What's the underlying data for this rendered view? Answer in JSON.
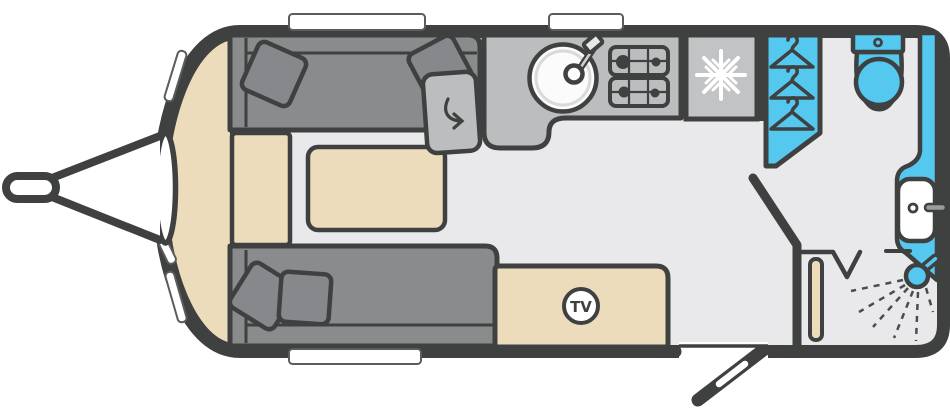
{
  "floorplan": {
    "type": "caravan-floorplan",
    "tv_badge": {
      "label": "TV"
    },
    "colors": {
      "outline": "#3F4040",
      "floor": "#E9E9EB",
      "upholstery": "#8A8B8D",
      "cushion": "#87888C",
      "worktop": "#BCBDBF",
      "fridge": "#C2C3C5",
      "wood": "#EDDCBB",
      "wet_area_blue": "#55C8F0",
      "white": "#FFFFFF",
      "spray": "#4A4C4E"
    },
    "features": [
      {
        "id": "tow-hitch",
        "label": "tow hitch"
      },
      {
        "id": "front-sofa-top",
        "label": "front lounge sofa (top)"
      },
      {
        "id": "front-sofa-bottom",
        "label": "front lounge sofa (bottom)"
      },
      {
        "id": "scatter-cushions",
        "label": "scatter cushions"
      },
      {
        "id": "front-chest",
        "label": "front chest"
      },
      {
        "id": "table",
        "label": "occasional table"
      },
      {
        "id": "swivel-worktop",
        "label": "swivel top extension"
      },
      {
        "id": "kitchen-sink",
        "label": "sink with tap"
      },
      {
        "id": "gas-hob",
        "label": "four burner hob"
      },
      {
        "id": "fridge-freezer",
        "label": "fridge freezer"
      },
      {
        "id": "wardrobe",
        "label": "wardrobe"
      },
      {
        "id": "washroom-door",
        "label": "washroom door"
      },
      {
        "id": "toilet",
        "label": "toilet"
      },
      {
        "id": "washbasin",
        "label": "washbasin with tap"
      },
      {
        "id": "shower",
        "label": "shower"
      },
      {
        "id": "tv-point",
        "label": "TV point"
      },
      {
        "id": "entrance-door",
        "label": "entrance door"
      },
      {
        "id": "windows",
        "label": "windows"
      }
    ]
  }
}
